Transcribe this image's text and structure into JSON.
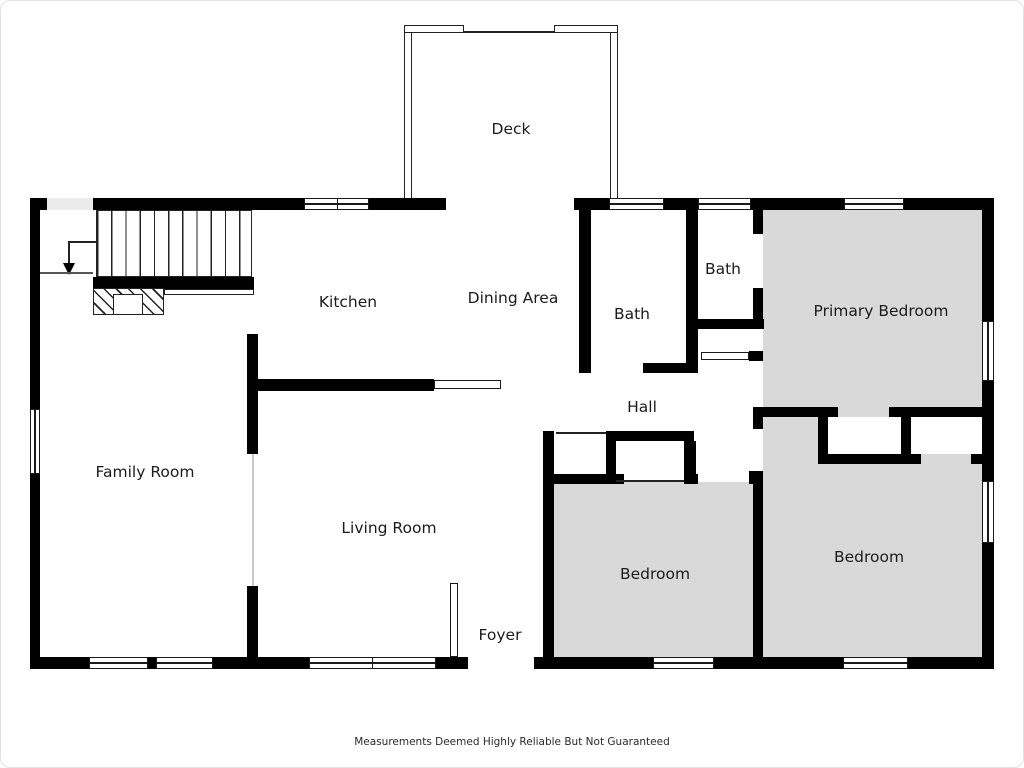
{
  "rooms": {
    "deck": "Deck",
    "kitchen": "Kitchen",
    "dining": "Dining Area",
    "bath_hall": "Bath",
    "bath_ensuite": "Bath",
    "primary_bedroom": "Primary Bedroom",
    "hall": "Hall",
    "family_room": "Family Room",
    "living_room": "Living Room",
    "bedroom_middle": "Bedroom",
    "bedroom_right": "Bedroom",
    "foyer": "Foyer"
  },
  "footer": {
    "disclaimer": "Measurements Deemed Highly Reliable But Not Guaranteed"
  },
  "icons": {
    "stairs": "stairs-down-arrow"
  },
  "colors": {
    "wall": "#000000",
    "room_fill": "#d9d9d9",
    "background": "#ffffff"
  }
}
